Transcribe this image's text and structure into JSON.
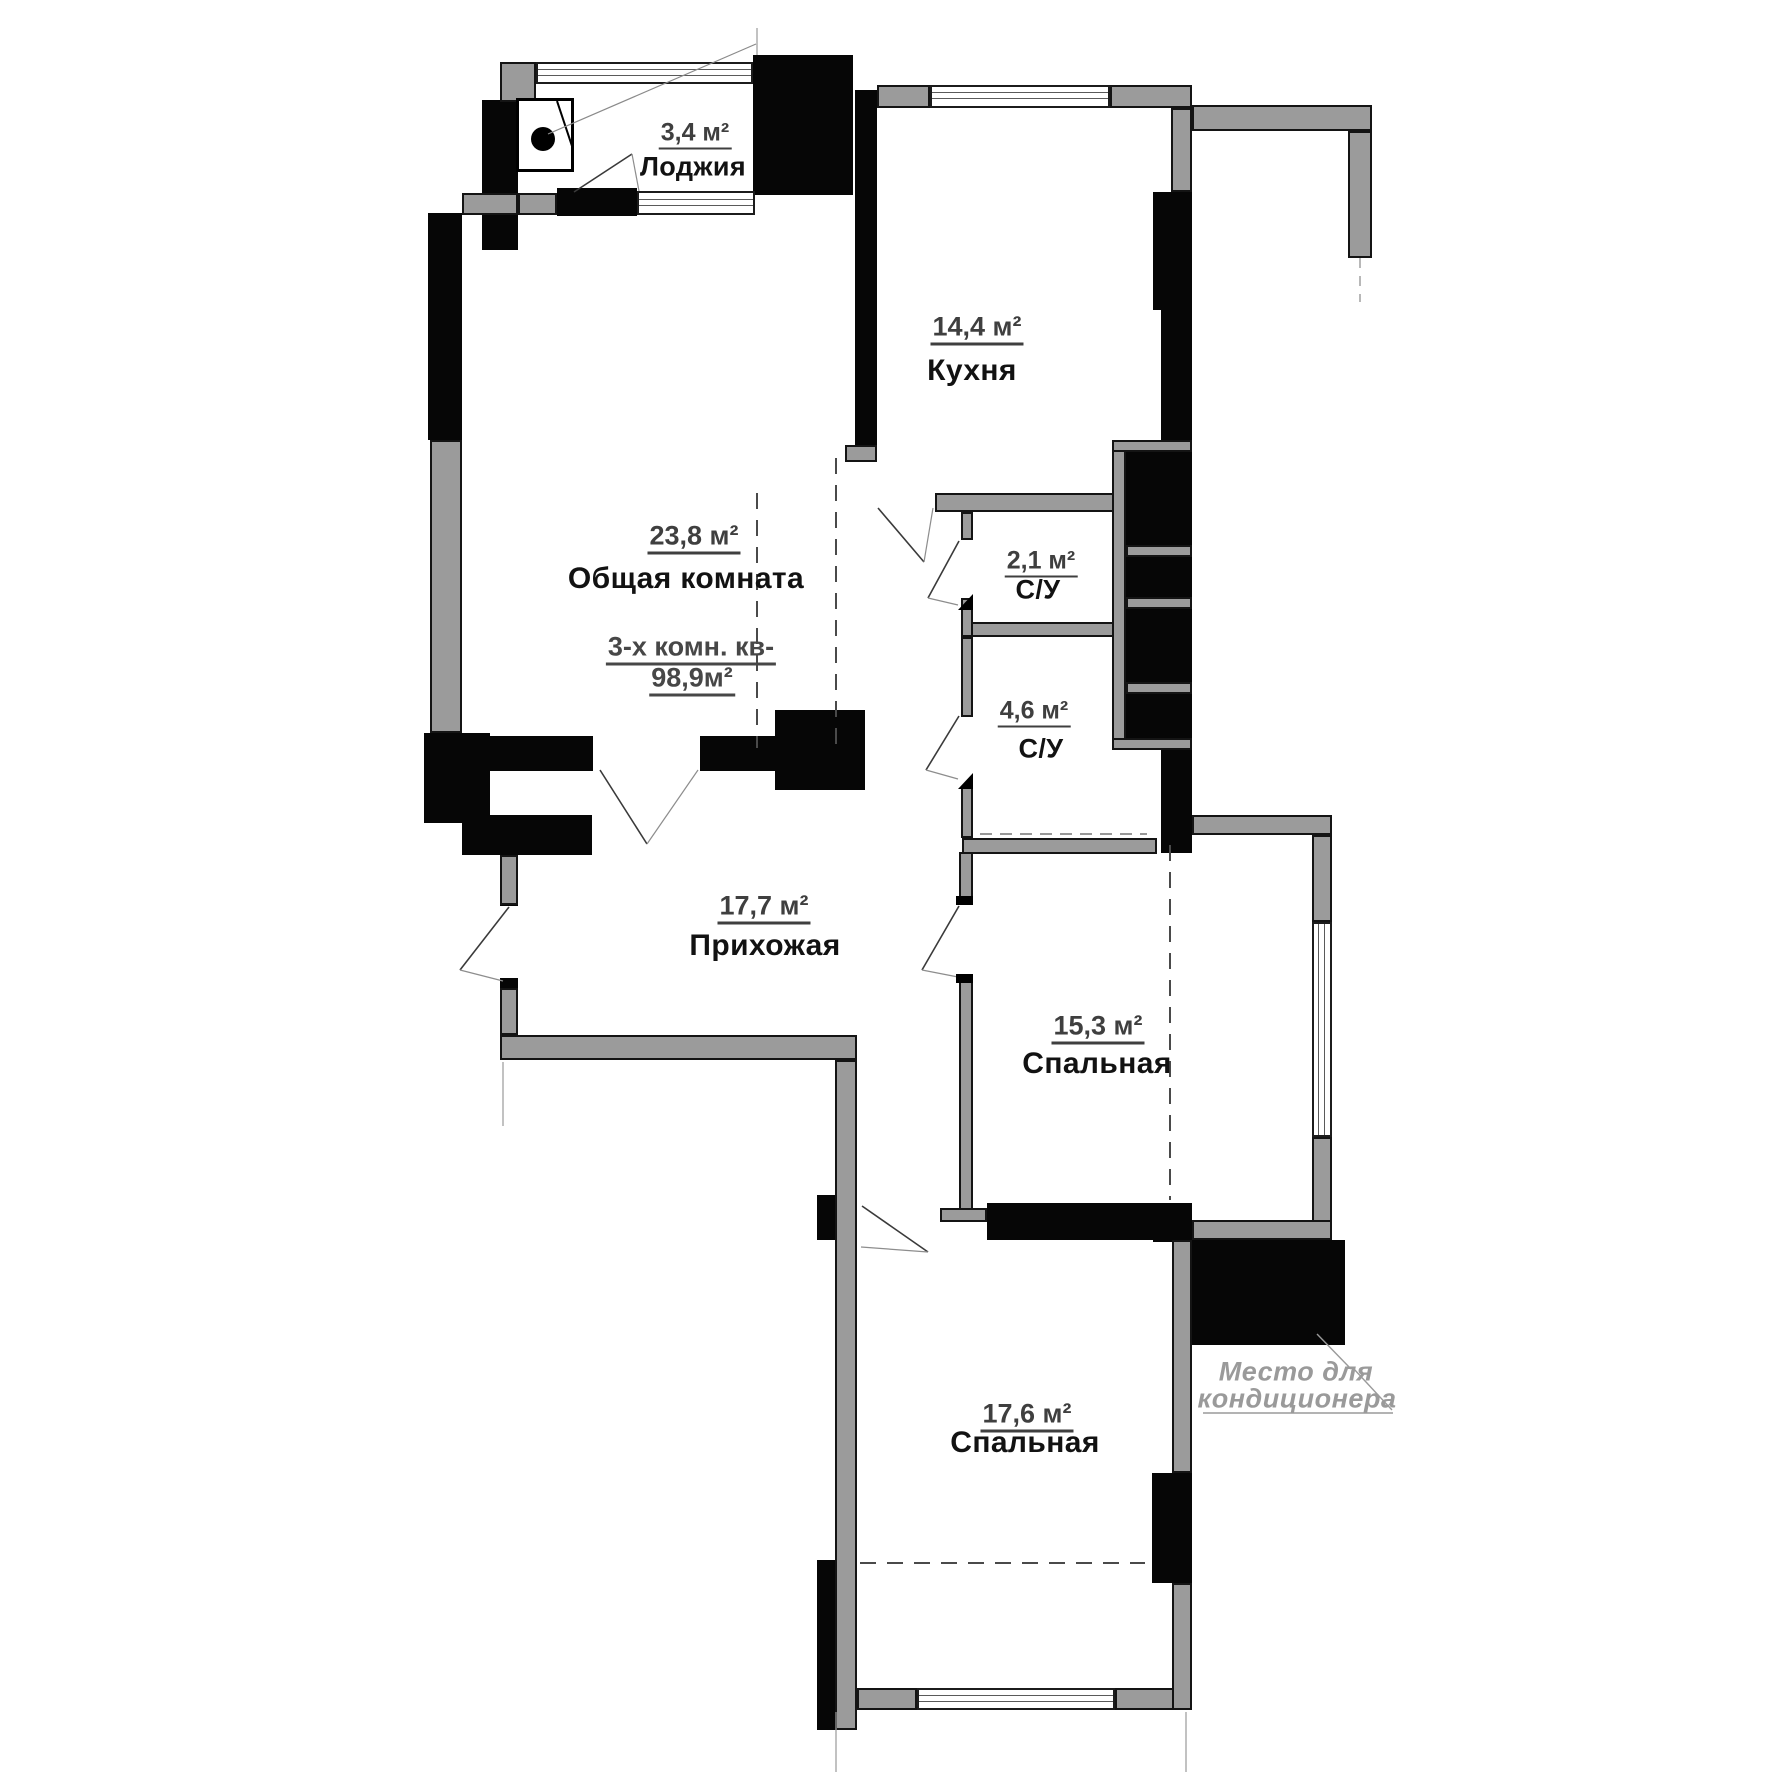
{
  "rooms": [
    {
      "id": "loggia",
      "area": "3,4 м²",
      "name": "Лоджия"
    },
    {
      "id": "kitchen",
      "area": "14,4 м²",
      "name": "Кухня"
    },
    {
      "id": "living",
      "area": "23,8 м²",
      "name": "Общая комната"
    },
    {
      "id": "wc_small",
      "area": "2,1 м²",
      "name": "С/У"
    },
    {
      "id": "wc_big",
      "area": "4,6 м²",
      "name": "С/У"
    },
    {
      "id": "hallway",
      "area": "17,7 м²",
      "name": "Прихожая"
    },
    {
      "id": "bedroom_east",
      "area": "15,3 м²",
      "name": "Спальная"
    },
    {
      "id": "bedroom_south",
      "area": "17,6 м²",
      "name": "Спальная"
    }
  ],
  "apartment": {
    "type_line": "3-х комн. кв-",
    "total_line": "98,9м²"
  },
  "annotation": {
    "line1": "Место для",
    "line2": "кондиционера"
  },
  "colors": {
    "wall_gray": "#9b9b9b",
    "wall_black": "#060606",
    "area_text": "#3f3f3f",
    "name_text": "#121212",
    "annotation_text": "#9a9a9a",
    "background": "#ffffff"
  }
}
